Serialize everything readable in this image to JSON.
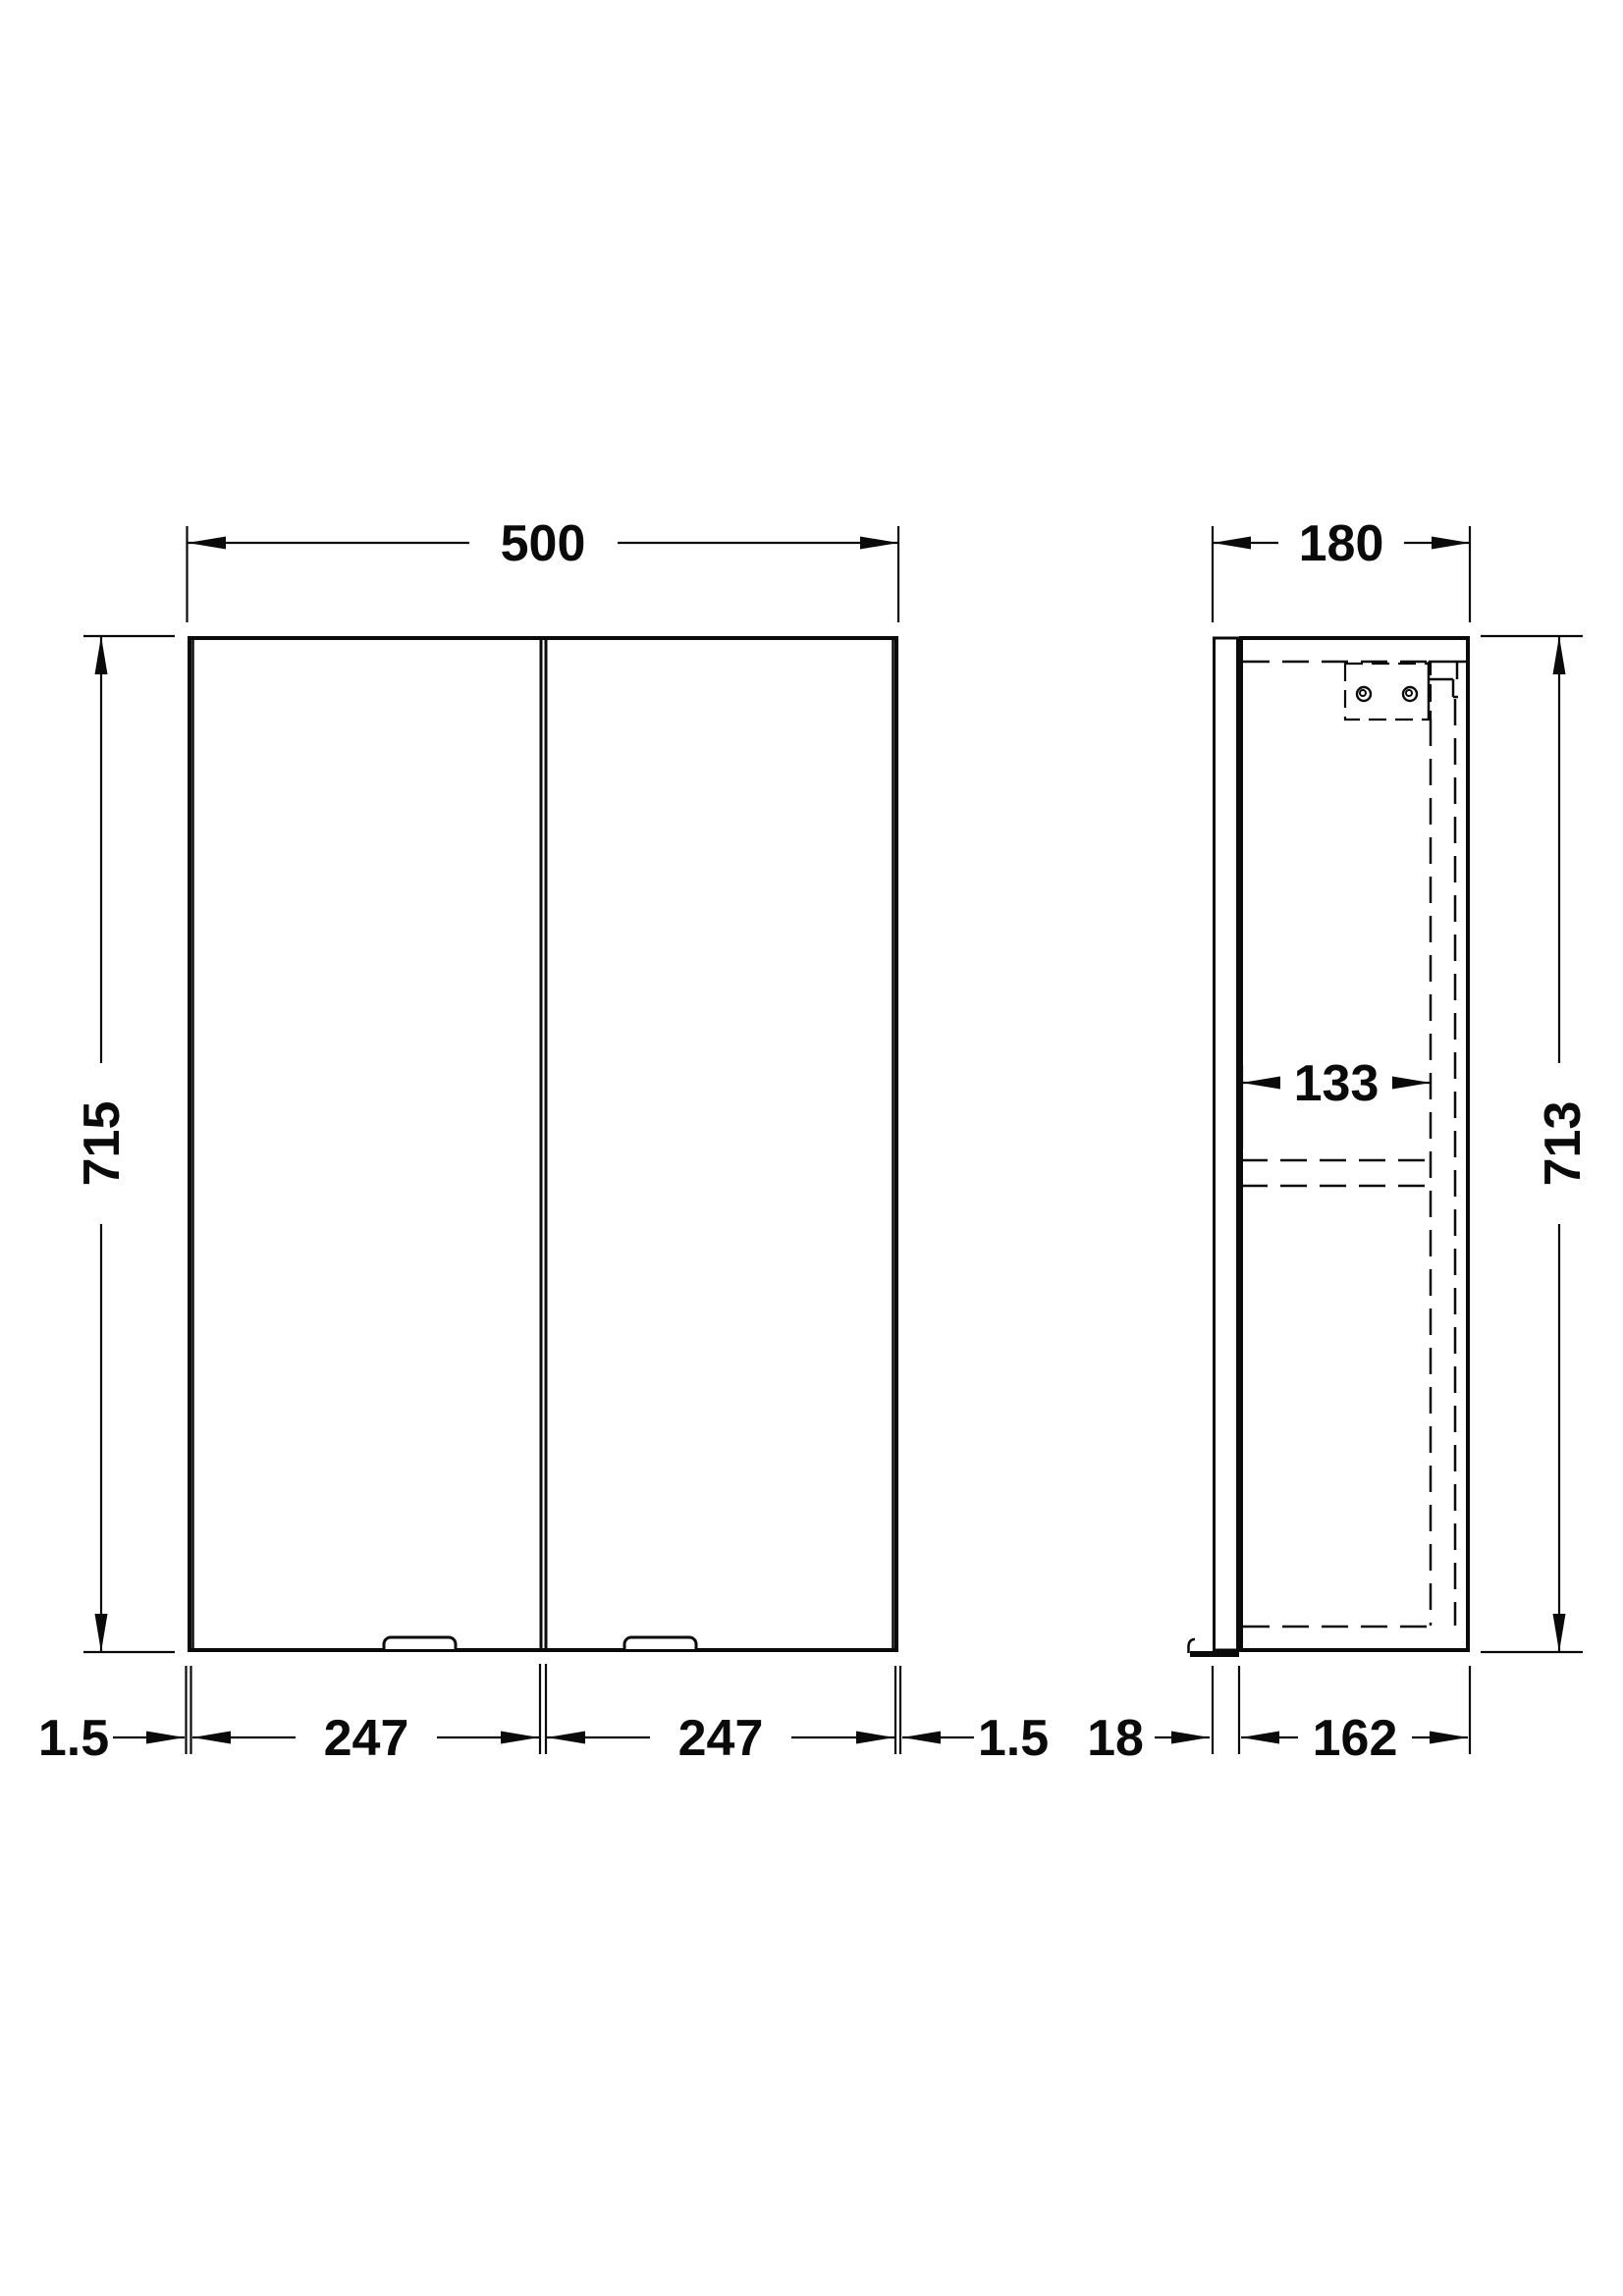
{
  "drawing": {
    "front_view": {
      "width": "500",
      "height": "715",
      "left_edge_gap": "1.5",
      "left_door_width": "247",
      "right_door_width": "247",
      "right_edge_gap": "1.5"
    },
    "side_view": {
      "depth": "180",
      "height": "713",
      "internal_depth": "133",
      "door_thickness": "18",
      "carcass_depth": "162"
    },
    "colors": {
      "line": "#0a0a0a",
      "background": "#ffffff"
    }
  }
}
